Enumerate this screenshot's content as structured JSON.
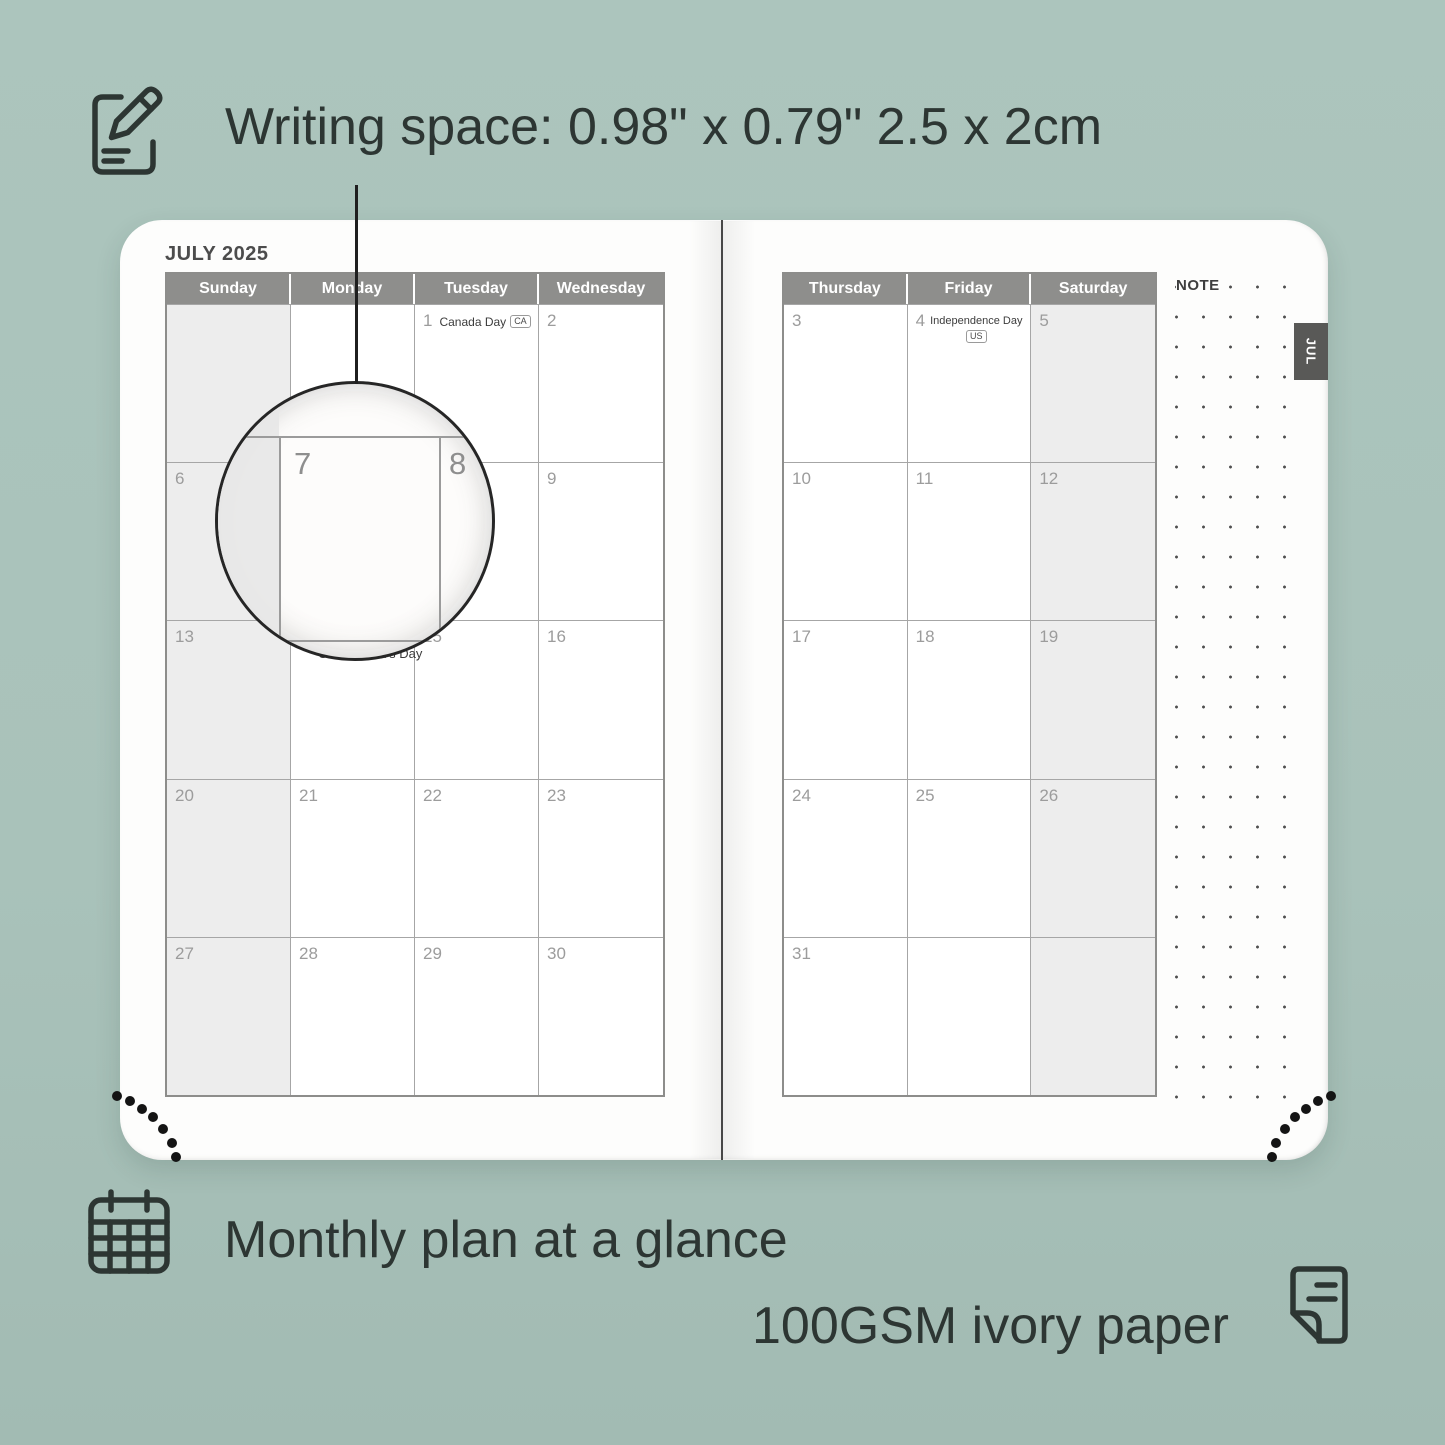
{
  "annotations": {
    "writing_space": "Writing space: 0.98\" x 0.79\" 2.5 x 2cm",
    "monthly_plan": "Monthly plan at a glance",
    "paper": "100GSM ivory paper"
  },
  "colors": {
    "background": "#a9c2ba",
    "sheet": "#fdfdfc",
    "header_gray": "#8e8e8c",
    "weekend_fill": "#ededed",
    "tab_gray": "#595957",
    "text_dark": "#2d3633"
  },
  "planner": {
    "month_title": "JULY 2025",
    "tab_label": "JUL",
    "note_label": "NOTE",
    "day_headers_left": [
      "Sunday",
      "Monday",
      "Tuesday",
      "Wednesday"
    ],
    "day_headers_right": [
      "Thursday",
      "Friday",
      "Saturday"
    ],
    "left_days": [
      [
        "",
        "",
        "1",
        "2"
      ],
      [
        "6",
        "7",
        "8",
        "9"
      ],
      [
        "13",
        "14",
        "15",
        "16"
      ],
      [
        "20",
        "21",
        "22",
        "23"
      ],
      [
        "27",
        "28",
        "29",
        "30"
      ]
    ],
    "right_days": [
      [
        "3",
        "4",
        "5"
      ],
      [
        "10",
        "11",
        "12"
      ],
      [
        "17",
        "18",
        "19"
      ],
      [
        "24",
        "25",
        "26"
      ],
      [
        "31",
        "",
        ""
      ]
    ],
    "holidays": {
      "canada_day": {
        "label": "Canada Day",
        "badge": "CA"
      },
      "independence_day": {
        "label": "Independence Day",
        "badge": "US"
      },
      "orangemens_day": {
        "label": "Orangemen's Day"
      }
    },
    "magnifier": {
      "left_day": "7",
      "right_day": "8"
    }
  }
}
